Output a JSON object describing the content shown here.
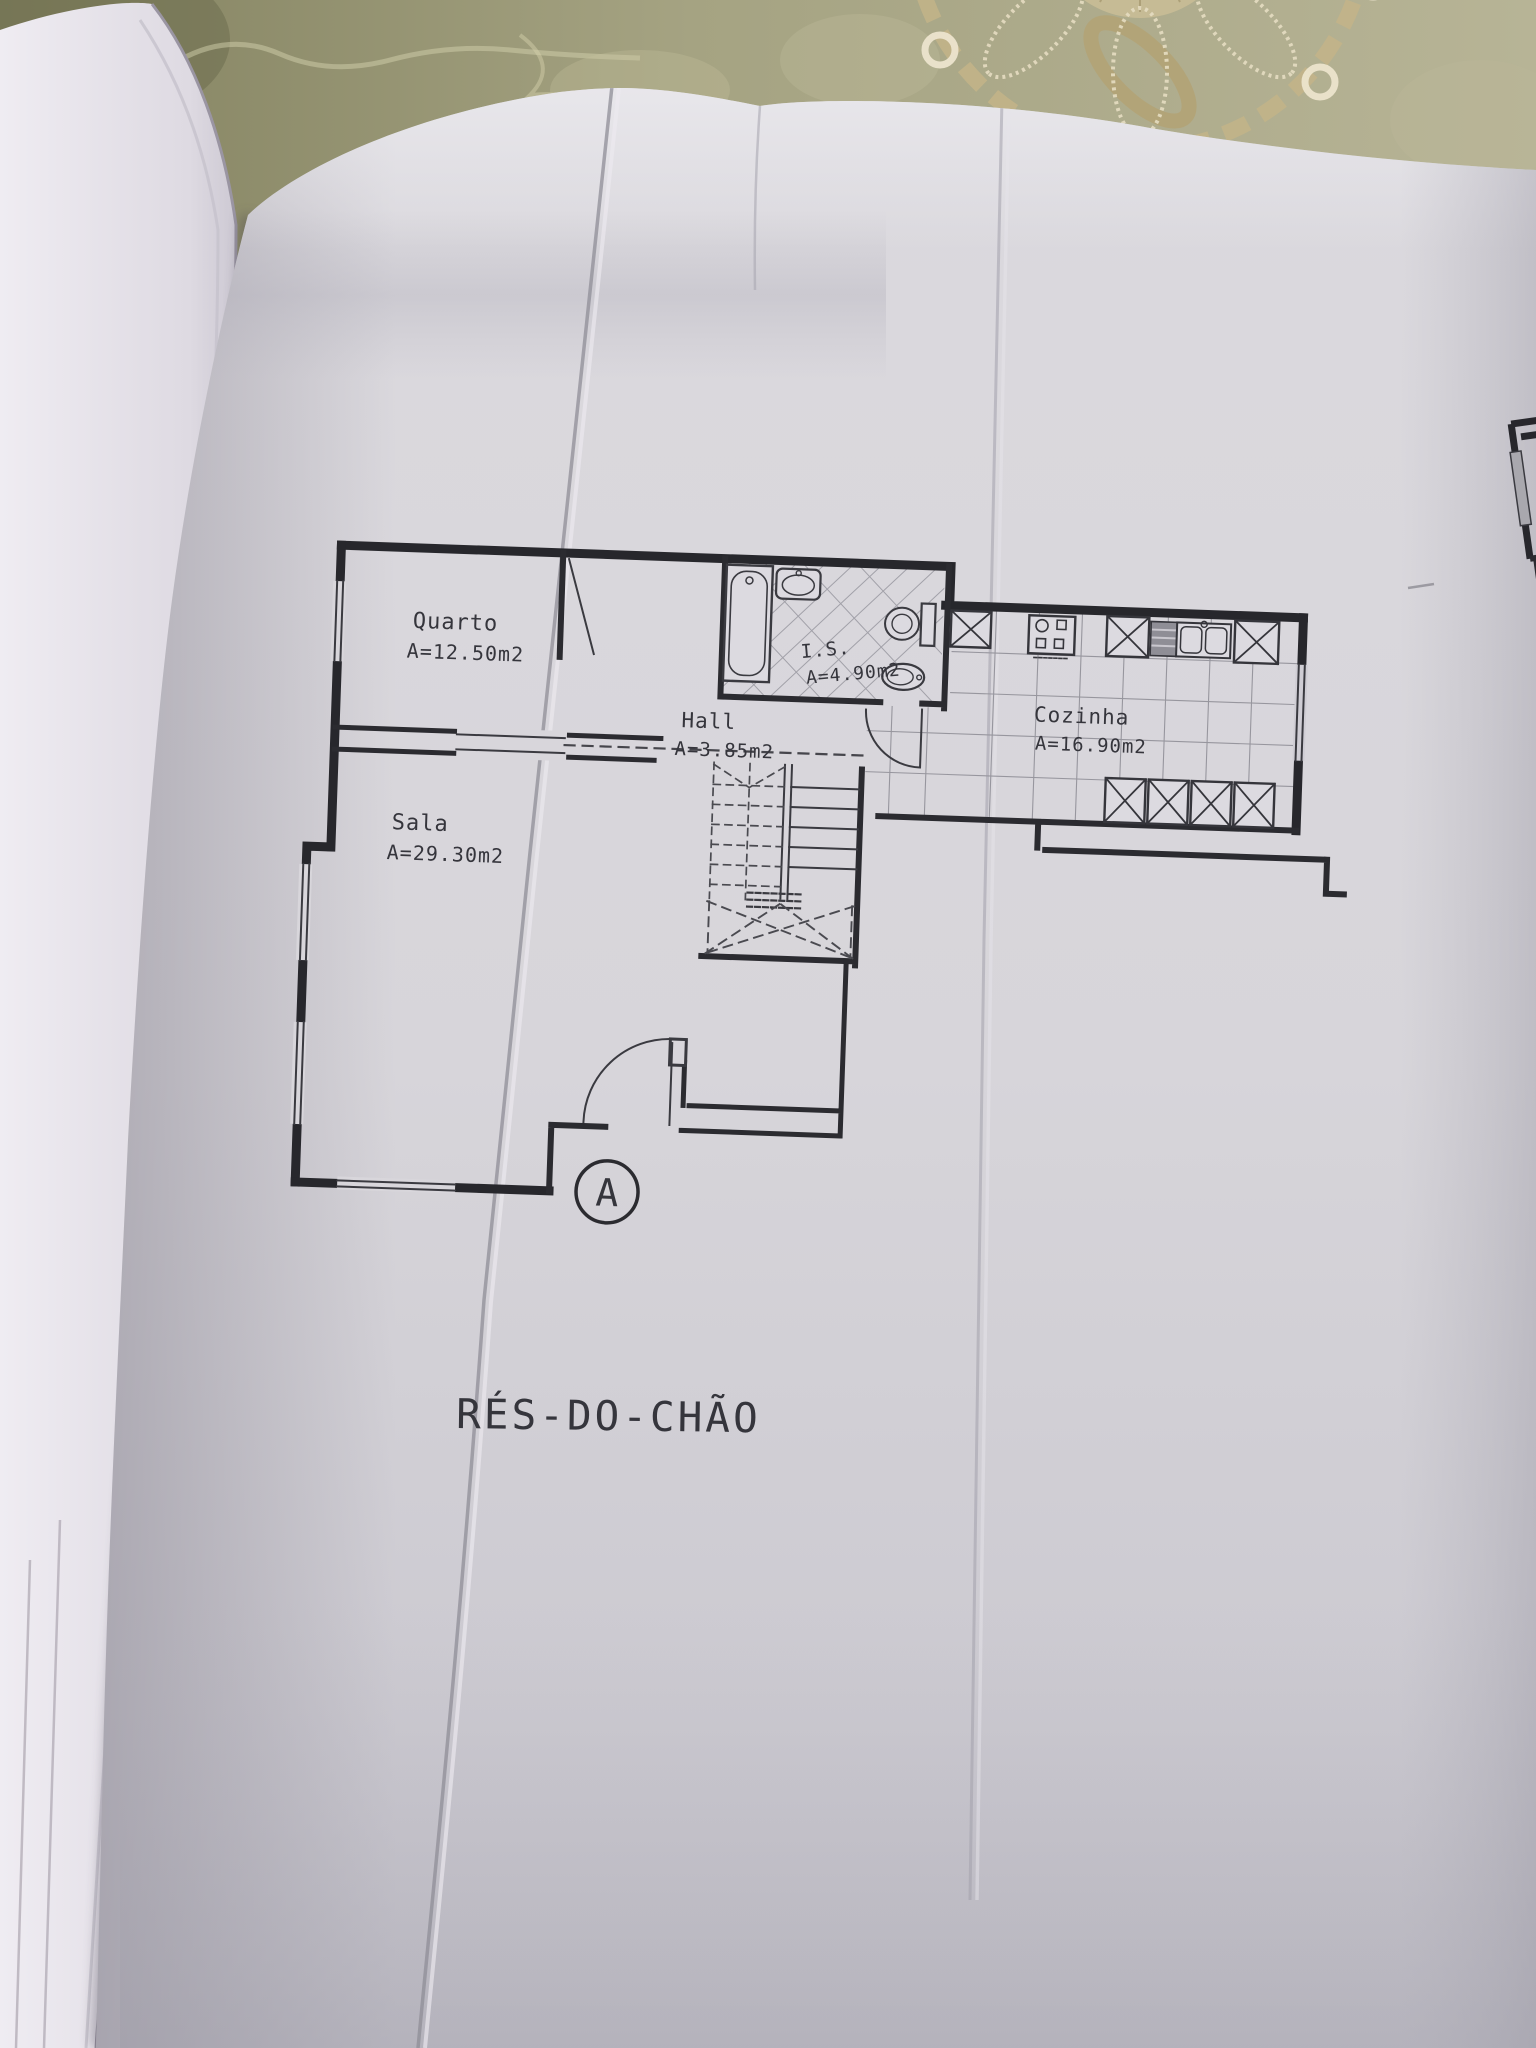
{
  "photo": {
    "scene": "hand-held photo of an architectural ground-floor plan on the right page of an open book, lying on an olive damask tablecloth with a gold lace doily at the top right",
    "floor_title": "RÉS-DO-CHÃO",
    "section_marker": "A"
  },
  "rooms": [
    {
      "name": "Quarto",
      "area": "A=12.50m2"
    },
    {
      "name": "Sala",
      "area": "A=29.30m2"
    },
    {
      "name": "Hall",
      "area": "A=3.85m2"
    },
    {
      "name": "I.S.",
      "area": "A=4.90m2"
    },
    {
      "name": "Cozinha",
      "area": "A=16.90m2"
    }
  ],
  "colors": {
    "paper": "#d9d7dc",
    "ink": "#2b2b30",
    "tablecloth": "#a3a180",
    "lace": "#cbbd94"
  }
}
